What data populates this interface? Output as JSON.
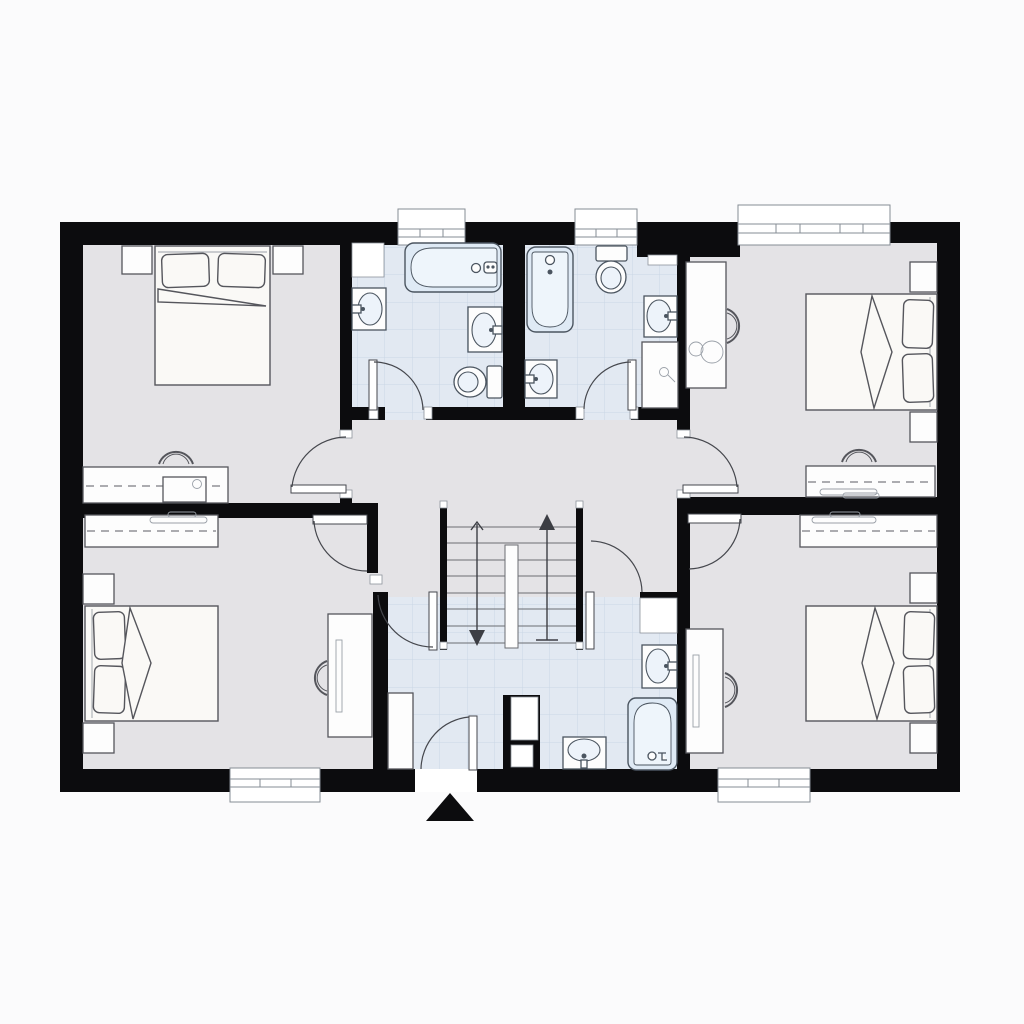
{
  "document": {
    "type": "architectural floor plan, upper floor with four bedrooms and three bathrooms",
    "text_labels": [],
    "entry_marker": "solid black triangle pointing up at the bottom entry door"
  },
  "colors": {
    "background": "#fbfbfc",
    "wall": "#0c0c0e",
    "room_floor_gray": "#e4e3e6",
    "bathroom_tile": "#e2e9f2",
    "tile_gridline": "#c9d6e5",
    "fixture_fill": "#dfeaf5",
    "furniture_fill": "#fdfdfd",
    "outline": "#55565c"
  },
  "rooms": [
    {
      "name": "bedroom-top-left",
      "floor": "gray",
      "furniture": [
        "double-bed with 2 pillows against top wall",
        "2 nightstands",
        "desk with dashed worktop line along bottom wall",
        "desk-chair",
        "door to hallway bottom-right"
      ]
    },
    {
      "name": "bathroom-top-left",
      "floor": "blue-tile",
      "fixtures": [
        "bathtub horizontal at top",
        "wall-sink on left wall",
        "wall-sink on right wall",
        "toilet bottom-right",
        "shelf top-left",
        "window in top wall",
        "door from hallway"
      ]
    },
    {
      "name": "bathroom-top-center",
      "floor": "blue-tile",
      "fixtures": [
        "bathtub vertical at left",
        "toilet top-right",
        "wall-sink bottom-left",
        "wall-sink on right wall",
        "tall cabinet on right wall",
        "shelf",
        "window in top wall",
        "door from hallway"
      ]
    },
    {
      "name": "bedroom-top-right",
      "floor": "gray",
      "furniture": [
        "double-bed with 2 pillows against right wall",
        "2 nightstands",
        "desk with lamp on left wall",
        "desk-chair",
        "wardrobe counter with dashed rail line and hangers along bottom wall",
        "second chair",
        "wide window in top wall",
        "door to hallway bottom-left"
      ]
    },
    {
      "name": "hallway-landing",
      "floor": "gray",
      "features": [
        "double-flight staircase with central divider",
        "up arrow on right flight",
        "down arrow on left flight"
      ]
    },
    {
      "name": "bathroom-bottom-center",
      "floor": "blue-tile",
      "fixtures": [
        "bathtub vertical bottom-right",
        "wall-sink on right wall",
        "sink bottom-center",
        "tall cabinet left",
        "cabinet top-right",
        "service shaft pillar",
        "entry door in bottom wall with swing arc",
        "doors to left and right hallway branches"
      ]
    },
    {
      "name": "bedroom-bottom-left",
      "floor": "gray",
      "furniture": [
        "wardrobe with hanger rail and dashed line at top",
        "double-bed with 2 pillows against left wall",
        "2 nightstands",
        "desk with monitor on right wall",
        "desk-chair",
        "window in bottom wall",
        "door at top-right"
      ]
    },
    {
      "name": "bedroom-bottom-right",
      "floor": "gray",
      "furniture": [
        "wardrobe with hanger rail and dashed line at top-right",
        "double-bed with 2 pillows against right wall",
        "2 nightstands",
        "desk with monitor on left wall",
        "desk-chair",
        "window in bottom wall",
        "door at top-left"
      ]
    }
  ],
  "stairs": {
    "flights": 2,
    "treads_per_flight": 8,
    "arrows": [
      "down (left flight)",
      "up (right flight)"
    ]
  },
  "totals": {
    "windows": 5,
    "interior_doors": 8,
    "entry_doors": 1,
    "beds": 4,
    "bathtubs": 3,
    "toilets": 2,
    "sinks": 6,
    "chairs": 5,
    "wardrobes_or_desk_counters": 6,
    "nightstands": 8
  }
}
